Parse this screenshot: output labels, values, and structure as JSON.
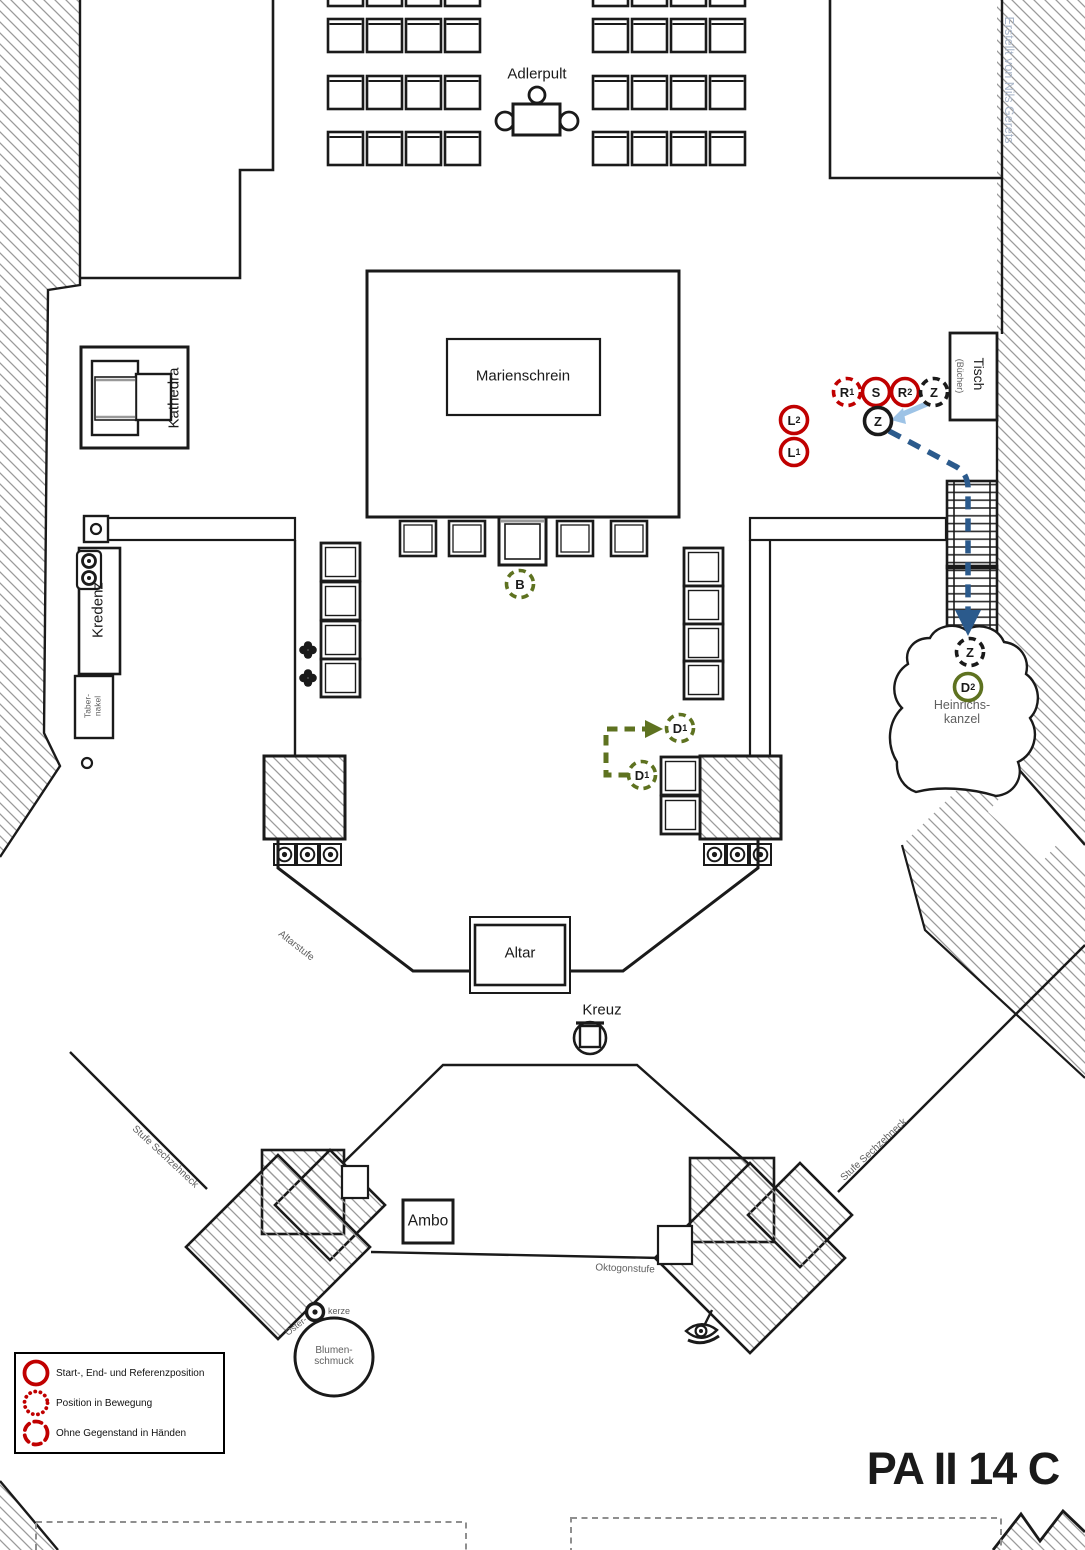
{
  "title": "PA II 14 C",
  "credit": "Erstellt von Nils Gerets",
  "colors": {
    "red": "#C00000",
    "olive": "#5E7220",
    "black": "#1a1a1a",
    "path_blue": "#2B5A8C",
    "arrow_lightblue": "#9DC3E6",
    "label_gray": "#5f5f5f",
    "credit_blue": "#A9B6C9",
    "hatch_gray": "#9a9a9a"
  },
  "labels": {
    "adlerpult": "Adlerpult",
    "marienschrein": "Marienschrein",
    "kathedra": "Kathedra",
    "tisch": "Tisch",
    "tisch_sub": "(Bücher)",
    "kredenz": "Kredenz",
    "tabernakel_line1": "Taber-",
    "tabernakel_line2": "nakel",
    "heinrichskanzel_line1": "Heinrichs-",
    "heinrichskanzel_line2": "kanzel",
    "altar": "Altar",
    "kreuz": "Kreuz",
    "altarstufe": "Altarstufe",
    "ambo": "Ambo",
    "oktogonstufe": "Oktogonstufe",
    "stufe_sechzehneck_left": "Stufe Sechzehneck",
    "stufe_sechzehneck_right": "Stufe Sechzehneck",
    "osterkerze_line1": "Oster-",
    "osterkerze_line2": "kerze",
    "blumenschmuck_line1": "Blumen-",
    "blumenschmuck_line2": "schmuck"
  },
  "markers": [
    {
      "id": "R1",
      "label": "R",
      "sub": "1",
      "x": 847,
      "y": 392,
      "color": "red",
      "style": "dashed"
    },
    {
      "id": "S",
      "label": "S",
      "sub": "",
      "x": 876,
      "y": 392,
      "color": "red",
      "style": "solid"
    },
    {
      "id": "R2",
      "label": "R",
      "sub": "2",
      "x": 905,
      "y": 392,
      "color": "red",
      "style": "solid"
    },
    {
      "id": "Z-table",
      "label": "Z",
      "sub": "",
      "x": 934,
      "y": 392,
      "color": "black",
      "style": "dashed"
    },
    {
      "id": "Z-center",
      "label": "Z",
      "sub": "",
      "x": 878,
      "y": 421,
      "color": "black",
      "style": "solid"
    },
    {
      "id": "L2",
      "label": "L",
      "sub": "2",
      "x": 794,
      "y": 420,
      "color": "red",
      "style": "solid"
    },
    {
      "id": "L1",
      "label": "L",
      "sub": "1",
      "x": 794,
      "y": 452,
      "color": "red",
      "style": "solid"
    },
    {
      "id": "B",
      "label": "B",
      "sub": "",
      "x": 520,
      "y": 584,
      "color": "olive",
      "style": "dashed"
    },
    {
      "id": "D1-end",
      "label": "D",
      "sub": "1",
      "x": 680,
      "y": 728,
      "color": "olive",
      "style": "dashed"
    },
    {
      "id": "D1-start",
      "label": "D",
      "sub": "1",
      "x": 642,
      "y": 775,
      "color": "olive",
      "style": "dashed"
    },
    {
      "id": "Z-stairs",
      "label": "Z",
      "sub": "",
      "x": 970,
      "y": 652,
      "color": "black",
      "style": "dashed"
    },
    {
      "id": "D2",
      "label": "D",
      "sub": "2",
      "x": 968,
      "y": 687,
      "color": "olive",
      "style": "solid"
    }
  ],
  "routes": [
    {
      "name": "z-route-to-heinrichskanzel",
      "color": "path_blue",
      "style": "dashed-arrow"
    },
    {
      "name": "z-handover-arrow",
      "color": "arrow_lightblue",
      "style": "solid-arrow"
    },
    {
      "name": "d1-route",
      "color": "olive",
      "style": "dashed-arrow"
    }
  ],
  "legend": {
    "items": [
      {
        "style": "solid",
        "label": "Start-, End- und Referenzposition"
      },
      {
        "style": "dotted",
        "label": "Position in Bewegung"
      },
      {
        "style": "dashed",
        "label": "Ohne Gegenstand in Händen"
      }
    ]
  }
}
